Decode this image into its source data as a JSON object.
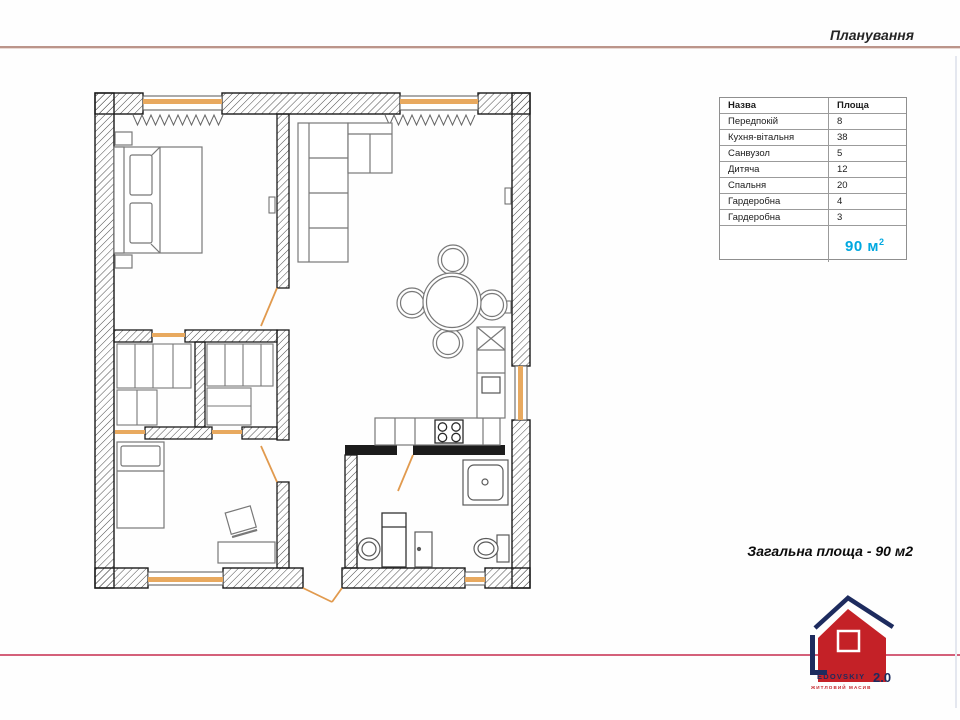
{
  "header": {
    "title": "Планування"
  },
  "table": {
    "headers": [
      "Назва",
      "Площа"
    ],
    "rows": [
      {
        "name": "Передпокій",
        "area": "8"
      },
      {
        "name": "Кухня-вітальня",
        "area": "38"
      },
      {
        "name": "Санвузол",
        "area": "5"
      },
      {
        "name": "Дитяча",
        "area": "12"
      },
      {
        "name": "Спальня",
        "area": "20"
      },
      {
        "name": "Гардеробна",
        "area": "4"
      },
      {
        "name": "Гардеробна",
        "area": "3"
      }
    ],
    "total": {
      "value": "90 м",
      "sup": "2"
    }
  },
  "caption": {
    "text": "Загальна площа - 90 м2"
  },
  "logo": {
    "name": "EDOVSKIY",
    "version": "2.0",
    "tagline": "ЖИТЛОВИЙ МАСИВ"
  },
  "colors": {
    "accent_orange": "#E8A95F",
    "total_cyan": "#00A8E0",
    "top_rule": "#BB958A",
    "bottom_rule": "#D4607A",
    "logo_red": "#C42127",
    "logo_navy": "#1D2B5E"
  }
}
